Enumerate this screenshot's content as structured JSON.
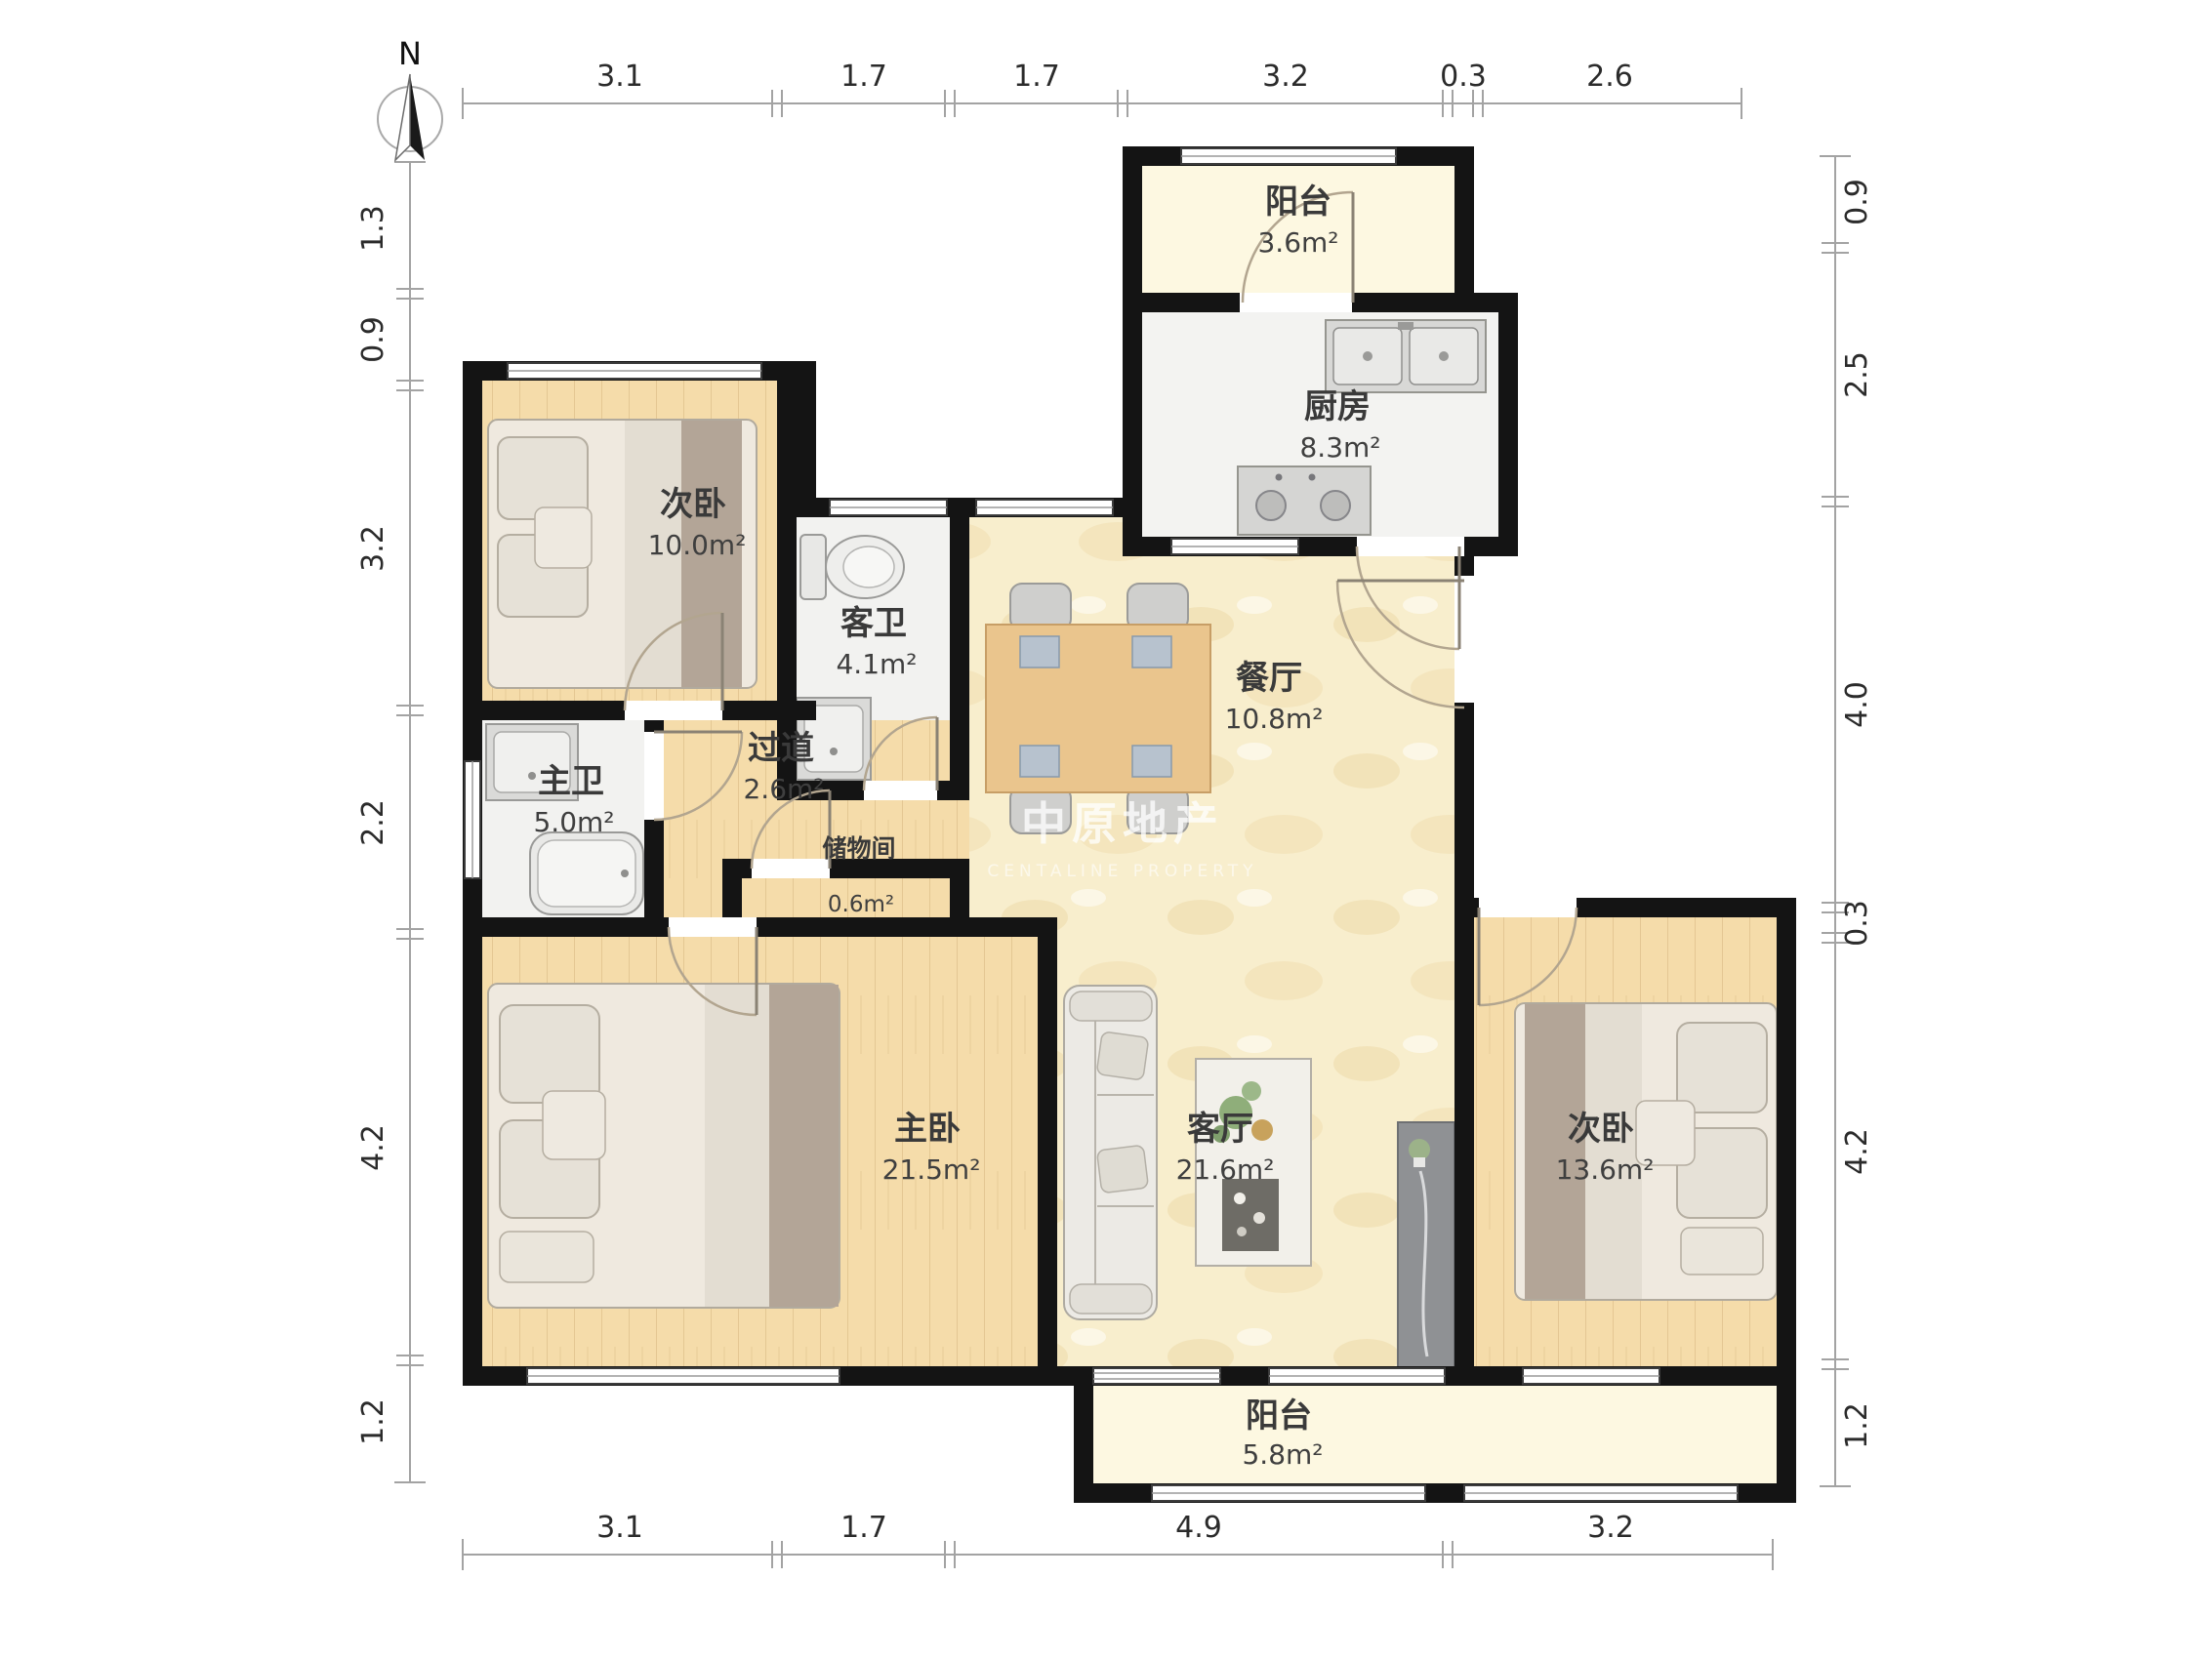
{
  "compass": {
    "north_label": "N"
  },
  "watermark": {
    "brand": "中原地产",
    "subbrand": "CENTALINE PROPERTY"
  },
  "dimensions": {
    "top": [
      "3.1",
      "1.7",
      "1.7",
      "3.2",
      "0.3",
      "2.6"
    ],
    "bottom": [
      "3.1",
      "1.7",
      "4.9",
      "3.2"
    ],
    "left": [
      "1.3",
      "0.9",
      "3.2",
      "2.2",
      "4.2",
      "1.2"
    ],
    "right": [
      "0.9",
      "2.5",
      "4.0",
      "0.3",
      "4.2",
      "1.2"
    ]
  },
  "rooms": {
    "balcony_top": {
      "name": "阳台",
      "area": "3.6m²"
    },
    "kitchen": {
      "name": "厨房",
      "area": "8.3m²"
    },
    "bedroom_top_left": {
      "name": "次卧",
      "area": "10.0m²"
    },
    "guest_bath": {
      "name": "客卫",
      "area": "4.1m²"
    },
    "dining": {
      "name": "餐厅",
      "area": "10.8m²"
    },
    "master_bath": {
      "name": "主卫",
      "area": "5.0m²"
    },
    "hallway": {
      "name": "过道",
      "area": "2.6m²"
    },
    "storage": {
      "name": "储物间",
      "area": "0.6m²"
    },
    "master_bedroom": {
      "name": "主卧",
      "area": "21.5m²"
    },
    "living": {
      "name": "客厅",
      "area": "21.6m²"
    },
    "bedroom_right": {
      "name": "次卧",
      "area": "13.6m²"
    },
    "balcony_bottom": {
      "name": "阳台",
      "area": "5.8m²"
    }
  }
}
